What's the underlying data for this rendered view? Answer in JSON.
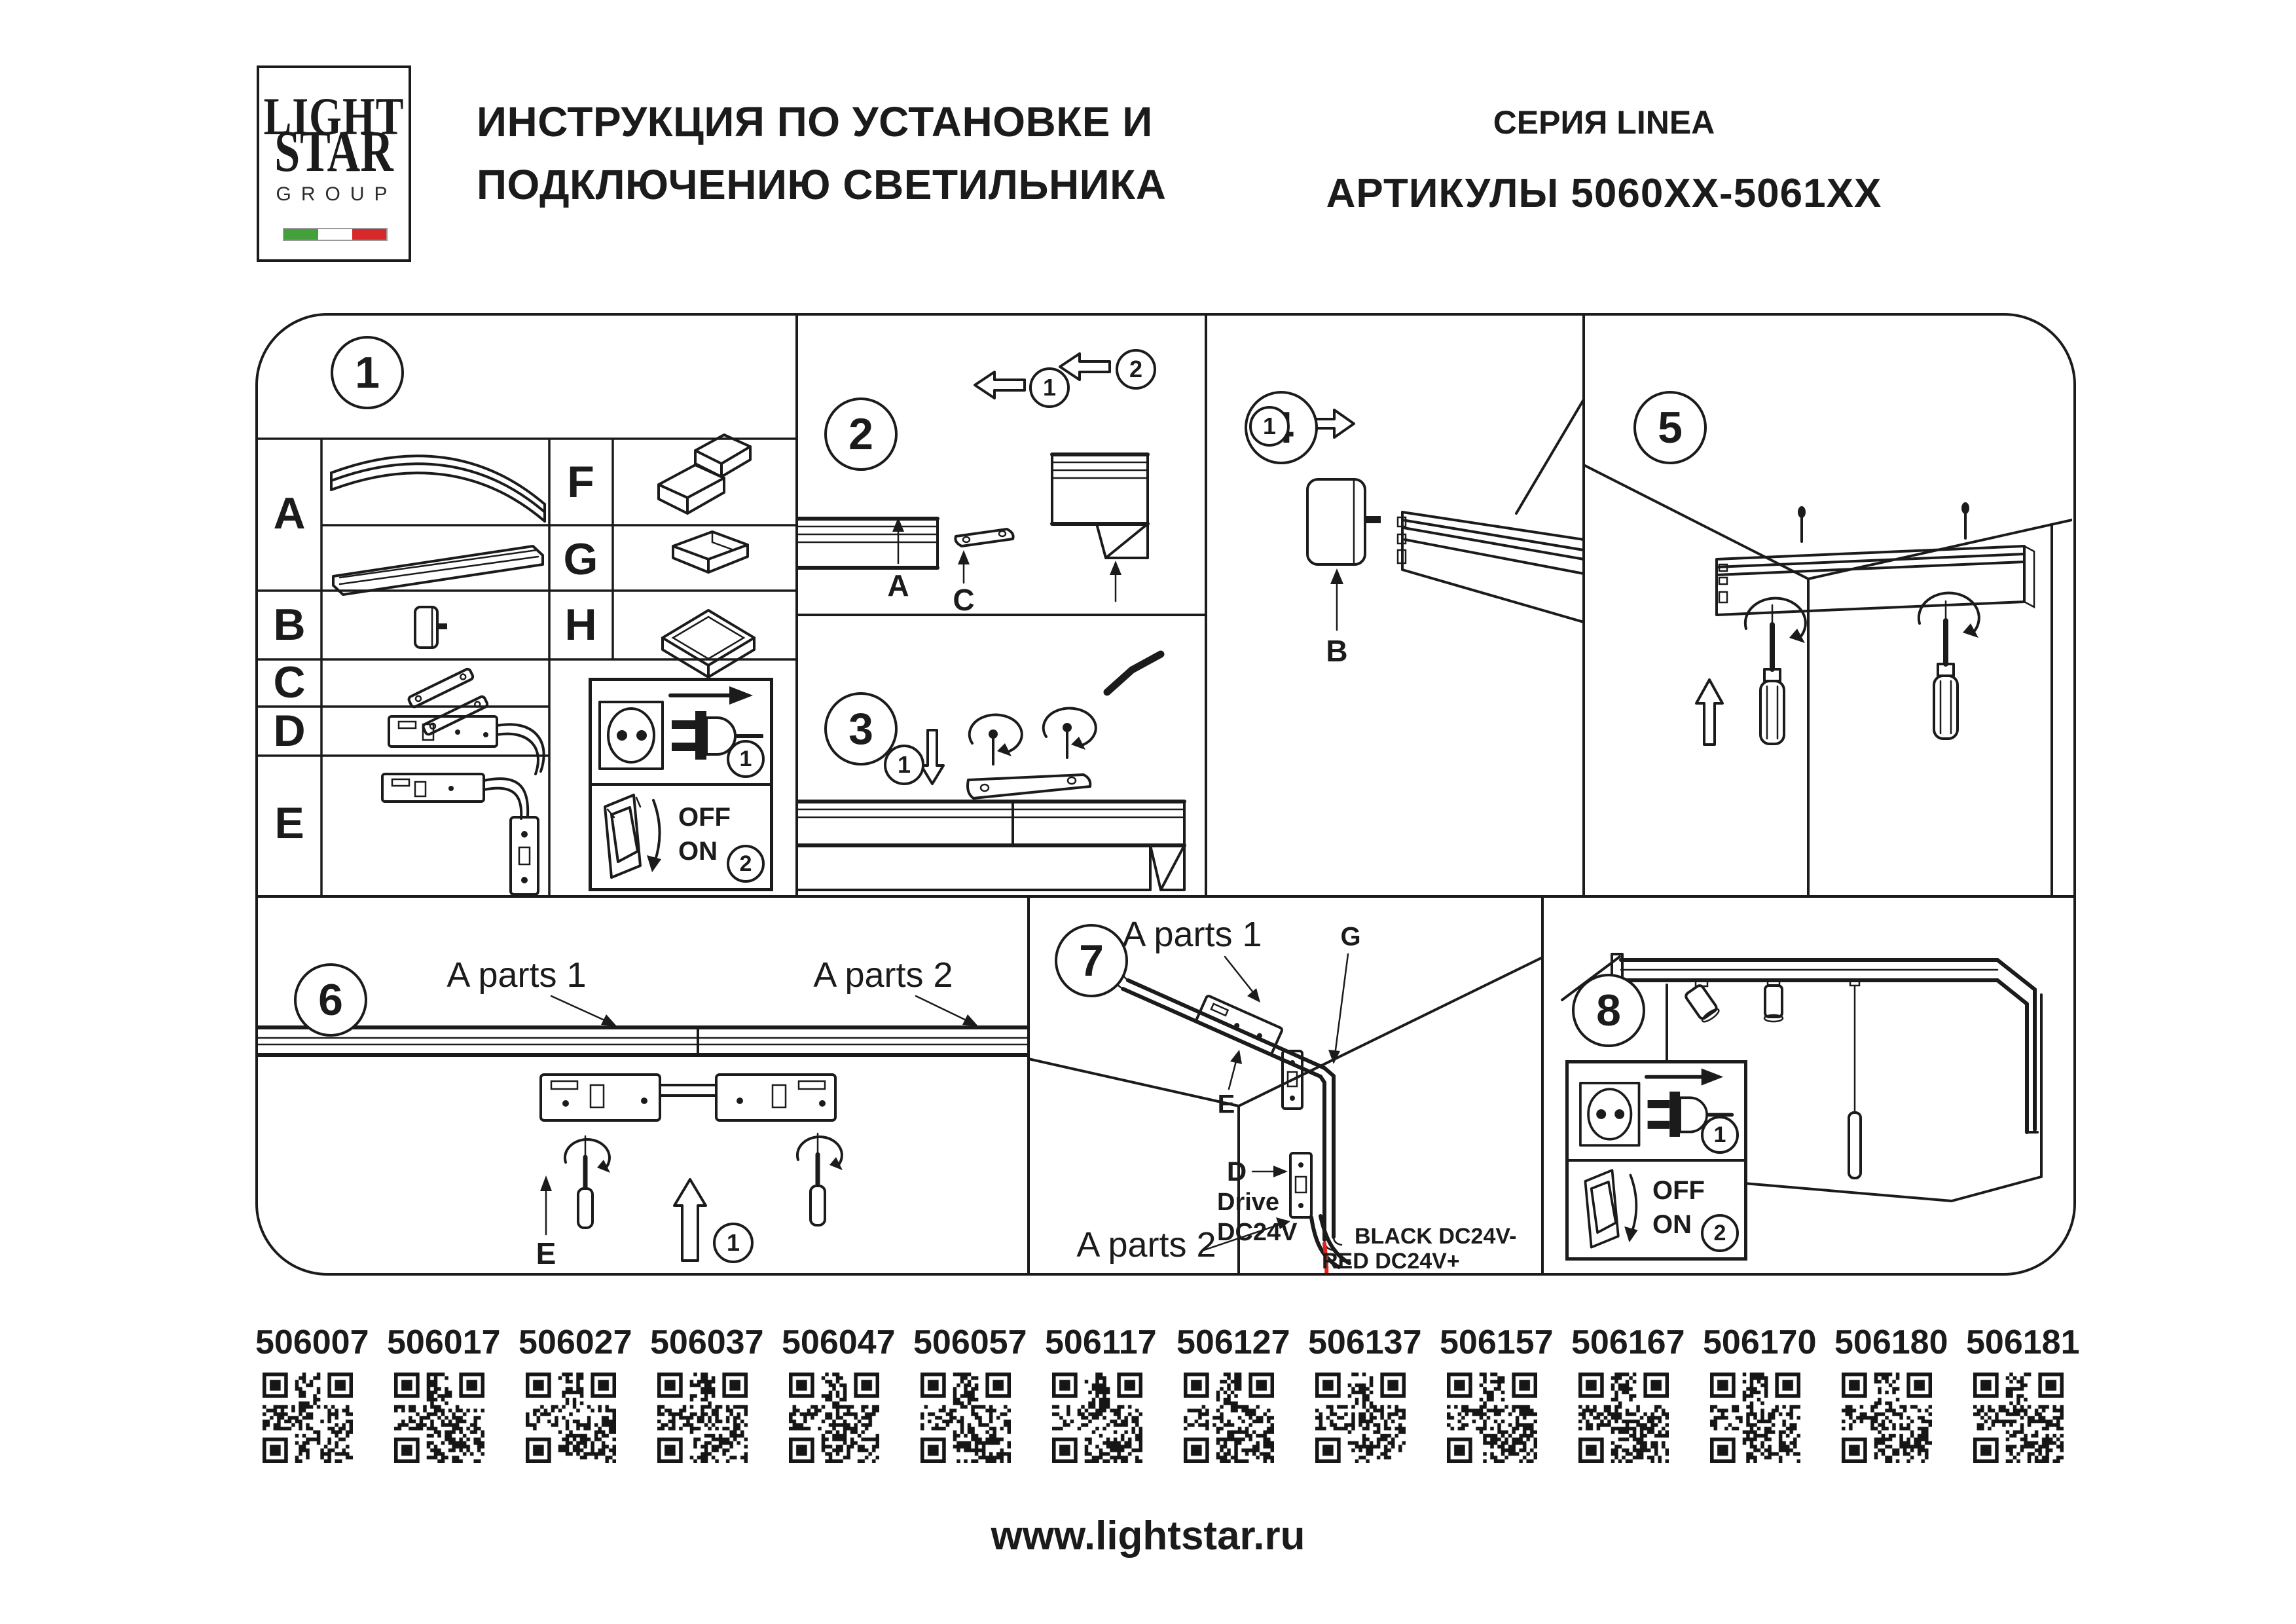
{
  "colors": {
    "ink": "#1b1b1b",
    "red": "#e0231c",
    "flag_green": "#44a03b",
    "flag_white": "#ffffff",
    "flag_red": "#d7282a"
  },
  "header": {
    "logo": {
      "word1": "LIGHT",
      "word2": "STAR",
      "word3": "GROUP"
    },
    "title_line1": "ИНСТРУКЦИЯ ПО УСТАНОВКЕ И",
    "title_line2": "ПОДКЛЮЧЕНИЮ СВЕТИЛЬНИКА",
    "series": "СЕРИЯ LINEA",
    "articles": "АРТИКУЛЫ 5060XX-5061XX"
  },
  "shared": {
    "power_box": {
      "plug_step": "1",
      "switch_step": "2",
      "off": "OFF",
      "on": "ON"
    }
  },
  "panels": {
    "p1": {
      "number": "1",
      "letter_a": "A",
      "letter_b": "B",
      "letter_c": "C",
      "letter_d": "D",
      "letter_e": "E",
      "letter_f": "F",
      "letter_g": "G",
      "letter_h": "H"
    },
    "p2": {
      "number": "2",
      "step1": "1",
      "step2": "2",
      "label_a": "A",
      "label_c": "C"
    },
    "p3": {
      "number": "3",
      "step1": "1"
    },
    "p4": {
      "number": "4",
      "step1": "1",
      "label_b": "B"
    },
    "p5": {
      "number": "5"
    },
    "p6": {
      "number": "6",
      "a_parts_1": "A parts 1",
      "a_parts_2": "A parts 2",
      "label_e": "E",
      "step1": "1"
    },
    "p7": {
      "number": "7",
      "a_parts_1": "A parts 1",
      "a_parts_2": "A parts 2",
      "label_g": "G",
      "label_e": "E",
      "label_d": "D",
      "drive_line1": "Drive",
      "drive_line2": "DC24V",
      "wire_black": "BLACK DC24V-",
      "wire_red": "RED DC24V+"
    },
    "p8": {
      "number": "8"
    }
  },
  "qr": {
    "items": [
      {
        "article": "506007"
      },
      {
        "article": "506017"
      },
      {
        "article": "506027"
      },
      {
        "article": "506037"
      },
      {
        "article": "506047"
      },
      {
        "article": "506057"
      },
      {
        "article": "506117"
      },
      {
        "article": "506127"
      },
      {
        "article": "506137"
      },
      {
        "article": "506157"
      },
      {
        "article": "506167"
      },
      {
        "article": "506170"
      },
      {
        "article": "506180"
      },
      {
        "article": "506181"
      }
    ]
  },
  "footer": {
    "website": "www.lightstar.ru"
  }
}
